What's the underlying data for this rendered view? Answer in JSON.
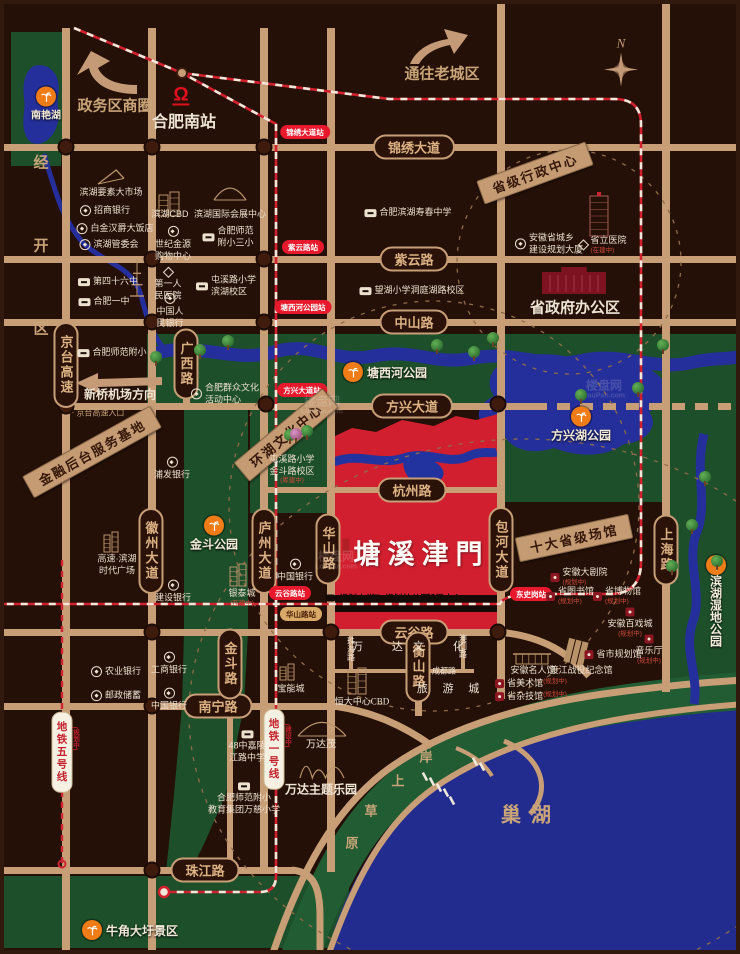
{
  "map": {
    "compass_label": "N",
    "watermark": {
      "line1": "楼盘网",
      "line2": "LouPan.com"
    },
    "colors": {
      "road": "#c89e77",
      "park_green": "#1d4f2a",
      "water_blue": "#252f9b",
      "project_red": "#d11f2f",
      "accent_tan": "#c49a74",
      "station_red": "#e8192c"
    },
    "items": [
      {
        "t": "pill",
        "x": 410,
        "y": 143,
        "s": "锦绣大道",
        "n": "road-jinxiu-avenue"
      },
      {
        "t": "pill",
        "x": 410,
        "y": 255,
        "s": "紫云路",
        "n": "road-ziyun-road"
      },
      {
        "t": "pill",
        "x": 410,
        "y": 318,
        "s": "中山路",
        "n": "road-zhongshan-road"
      },
      {
        "t": "pill",
        "x": 408,
        "y": 402,
        "s": "方兴大道",
        "n": "road-fangxing-avenue"
      },
      {
        "t": "pill",
        "x": 408,
        "y": 486,
        "s": "杭州路",
        "n": "road-hangzhou-road"
      },
      {
        "t": "pill",
        "x": 410,
        "y": 628,
        "s": "云谷路",
        "n": "road-yungu-road"
      },
      {
        "t": "pill",
        "x": 214,
        "y": 702,
        "s": "南宁路",
        "n": "road-nanning-road"
      },
      {
        "t": "pill",
        "x": 201,
        "y": 866,
        "s": "珠江路",
        "n": "road-zhujiang-road"
      },
      {
        "t": "pillv",
        "x": 62,
        "y": 361,
        "s": "京台高速",
        "n": "road-jingtai-expressway"
      },
      {
        "t": "pillv",
        "x": 182,
        "y": 360,
        "s": "广西路",
        "n": "road-guangxi-road"
      },
      {
        "t": "pillv",
        "x": 147,
        "y": 547,
        "s": "徽州大道",
        "n": "road-huizhou-avenue"
      },
      {
        "t": "pillv",
        "x": 260,
        "y": 547,
        "s": "庐州大道",
        "n": "road-luzhou-avenue"
      },
      {
        "t": "pillv",
        "x": 324,
        "y": 545,
        "s": "华山路",
        "n": "road-huashan-road"
      },
      {
        "t": "pillv",
        "x": 497,
        "y": 546,
        "s": "包河大道",
        "n": "road-baohe-avenue"
      },
      {
        "t": "pillv",
        "x": 662,
        "y": 546,
        "s": "上海路",
        "n": "road-shanghai-road"
      },
      {
        "t": "pillv",
        "x": 414,
        "y": 663,
        "s": "衡山路",
        "n": "road-hengshan-road"
      },
      {
        "t": "pillv",
        "x": 226,
        "y": 660,
        "s": "金斗路",
        "n": "road-jindou-road"
      },
      {
        "t": "st",
        "x": 301,
        "y": 128,
        "s": "锦绣大道站"
      },
      {
        "t": "st",
        "x": 299,
        "y": 243,
        "s": "紫云路站"
      },
      {
        "t": "st",
        "x": 299,
        "y": 303,
        "s": "塘西河公园站"
      },
      {
        "t": "st",
        "x": 298,
        "y": 386,
        "s": "方兴大道站"
      },
      {
        "t": "st",
        "x": 286,
        "y": 589,
        "s": "云谷路站"
      },
      {
        "t": "st2",
        "x": 297,
        "y": 610,
        "s": "华山路站"
      },
      {
        "t": "st",
        "x": 527,
        "y": 590,
        "s": "东史岗站"
      },
      {
        "t": "mtag",
        "x": 270,
        "y": 745,
        "s": "地铁一号线",
        "sub": "(建设中)",
        "n": "metro-line-1-label"
      },
      {
        "t": "mtag",
        "x": 58,
        "y": 748,
        "s": "地铁五号线",
        "sub": "(规划中)",
        "n": "metro-line-5-label"
      },
      {
        "t": "area",
        "x": 111,
        "y": 101,
        "s": "政务区商圈",
        "sz": 15,
        "c": "tan",
        "b": 1
      },
      {
        "t": "area",
        "x": 438,
        "y": 69,
        "s": "通往老城区",
        "sz": 15,
        "c": "tan",
        "b": 1
      },
      {
        "t": "area",
        "x": 180,
        "y": 116,
        "s": "合肥南站",
        "sz": 16,
        "c": "wh",
        "b": 1,
        "n": "hefei-south-station-label"
      },
      {
        "t": "rail",
        "x": 177,
        "y": 92,
        "n": "railway-station-icon"
      },
      {
        "t": "area",
        "x": 36,
        "y": 275,
        "s": "经开区",
        "sz": 15,
        "c": "tan",
        "b": 1,
        "vert": 1,
        "ls": 68
      },
      {
        "t": "area",
        "x": 571,
        "y": 303,
        "s": "省政府办公区",
        "sz": 15,
        "c": "wh",
        "b": 1
      },
      {
        "t": "area",
        "x": 527,
        "y": 809,
        "s": "巢湖",
        "sz": 20,
        "c": "tan",
        "b": 1,
        "ls": 10,
        "n": "chao-lake-label"
      },
      {
        "t": "area",
        "x": 116,
        "y": 390,
        "s": "新桥机场方向",
        "sz": 12,
        "c": "wh",
        "b": 1
      },
      {
        "t": "area",
        "x": 94,
        "y": 409,
        "s": "· 京台高速入口",
        "sz": 8,
        "c": "tan"
      },
      {
        "t": "area",
        "x": 380,
        "y": 642,
        "s": "万 达",
        "sz": 11,
        "c": "wh",
        "ls": 13
      },
      {
        "t": "area",
        "x": 441,
        "y": 642,
        "s": "文 化",
        "sz": 11,
        "c": "wh",
        "ls": 13
      },
      {
        "t": "area",
        "x": 447,
        "y": 684,
        "s": "旅 游 城",
        "sz": 11,
        "c": "wh",
        "ls": 6
      },
      {
        "t": "area",
        "x": 347,
        "y": 645,
        "s": "珠海路",
        "sz": 8,
        "c": "wh",
        "vert": 1
      },
      {
        "t": "area",
        "x": 459,
        "y": 642,
        "s": "澳门路",
        "sz": 8,
        "c": "wh",
        "vert": 1
      },
      {
        "t": "area",
        "x": 440,
        "y": 667,
        "s": "成都路",
        "sz": 8,
        "c": "wh"
      },
      {
        "t": "area",
        "x": 358,
        "y": 697,
        "s": "恒大中心CBD",
        "sz": 9,
        "c": "wh"
      },
      {
        "t": "area",
        "x": 287,
        "y": 684,
        "s": "宝能城",
        "sz": 9,
        "c": "wh"
      },
      {
        "t": "area",
        "x": 317,
        "y": 739,
        "s": "万达茂",
        "sz": 10,
        "c": "wh"
      },
      {
        "t": "area",
        "x": 317,
        "y": 785,
        "s": "万达主题乐园",
        "sz": 12,
        "c": "wh",
        "b": 1
      },
      {
        "t": "ch",
        "x": 422,
        "y": 752,
        "s": "岸"
      },
      {
        "t": "ch",
        "x": 394,
        "y": 776,
        "s": "上"
      },
      {
        "t": "ch",
        "x": 367,
        "y": 806,
        "s": "草"
      },
      {
        "t": "ch",
        "x": 348,
        "y": 838,
        "s": "原"
      },
      {
        "t": "banner",
        "x": 88,
        "y": 448,
        "s": "金融后台服务基地",
        "rot": -29
      },
      {
        "t": "banner",
        "x": 531,
        "y": 169,
        "s": "省级行政中心",
        "rot": -20
      },
      {
        "t": "banner",
        "x": 570,
        "y": 534,
        "s": "十大省级场馆",
        "rot": -12
      },
      {
        "t": "banner",
        "x": 282,
        "y": 431,
        "s": "环湖文化中心",
        "rot": -40
      },
      {
        "t": "mark",
        "x": 381,
        "y": 368,
        "s": "塘西河公园",
        "lp": "r",
        "n": "tangxihe-park-marker"
      },
      {
        "t": "mark",
        "x": 577,
        "y": 421,
        "s": "方兴湖公园",
        "lp": "b",
        "n": "fangxinghu-park-marker"
      },
      {
        "t": "mark",
        "x": 210,
        "y": 530,
        "s": "金斗公园",
        "lp": "b",
        "n": "jindou-park-marker"
      },
      {
        "t": "mark",
        "x": 126,
        "y": 926,
        "s": "牛角大圩景区",
        "lp": "r",
        "n": "niujiaodaxu-scenic-marker"
      },
      {
        "t": "mark",
        "x": 712,
        "y": 597,
        "s": "滨湖湿地公园",
        "lp": "bv",
        "n": "binhu-wetland-park-marker"
      },
      {
        "t": "mark",
        "x": 42,
        "y": 100,
        "s": "南艳湖",
        "lp": "b",
        "sz": 10,
        "n": "nanyan-lake-marker"
      },
      {
        "t": "poi",
        "x": 107,
        "y": 189,
        "ls": [
          "滨湖要素大市场"
        ]
      },
      {
        "t": "poi",
        "x": 101,
        "y": 207,
        "ic": "bank",
        "ls": [
          "招商银行"
        ]
      },
      {
        "t": "poi",
        "x": 111,
        "y": 225,
        "ic": "bank",
        "ls": [
          "白金汉爵大饭店"
        ]
      },
      {
        "t": "poi",
        "x": 105,
        "y": 241,
        "ic": "bank",
        "ls": [
          "滨湖管委会"
        ]
      },
      {
        "t": "poi",
        "x": 166,
        "y": 211,
        "ls": [
          "滨湖CBD"
        ]
      },
      {
        "t": "poi",
        "x": 169,
        "y": 240,
        "ic": "bank",
        "lay": "c",
        "ls": [
          "世纪金源",
          "购物中心"
        ]
      },
      {
        "t": "poi",
        "x": 226,
        "y": 211,
        "ls": [
          "滨湖国际会展中心"
        ]
      },
      {
        "t": "poi",
        "x": 224,
        "y": 233,
        "ic": "school",
        "ls": [
          "合肥师范",
          "附小三小"
        ]
      },
      {
        "t": "poi",
        "x": 104,
        "y": 278,
        "ic": "school",
        "ls": [
          "第四十六中"
        ]
      },
      {
        "t": "poi",
        "x": 100,
        "y": 298,
        "ic": "school",
        "ls": [
          "合肥一中"
        ]
      },
      {
        "t": "poi",
        "x": 164,
        "y": 281,
        "ic": "diamond",
        "lay": "c",
        "ls": [
          "第一人",
          "民医院"
        ]
      },
      {
        "t": "poi",
        "x": 166,
        "y": 307,
        "ic": "bank",
        "lay": "c",
        "ls": [
          "中国人",
          "民银行"
        ]
      },
      {
        "t": "poi",
        "x": 222,
        "y": 282,
        "ic": "school",
        "ls": [
          "屯溪路小学",
          "滨湖校区"
        ]
      },
      {
        "t": "poi",
        "x": 404,
        "y": 209,
        "ic": "school",
        "ls": [
          "合肥滨湖寿春中学"
        ]
      },
      {
        "t": "poi",
        "x": 408,
        "y": 287,
        "ic": "school",
        "ls": [
          "望湖小学洞庭湖路校区"
        ]
      },
      {
        "t": "poi",
        "x": 545,
        "y": 240,
        "ic": "bank",
        "ls": [
          "安徽省城乡",
          "建设规划大厦"
        ]
      },
      {
        "t": "poi",
        "x": 599,
        "y": 241,
        "ic": "diamond",
        "ls": [
          "省立医院",
          "(在建中)"
        ]
      },
      {
        "t": "poi",
        "x": 108,
        "y": 349,
        "ic": "school",
        "ls": [
          "合肥师范附小"
        ]
      },
      {
        "t": "poi",
        "x": 221,
        "y": 390,
        "ic": "bank",
        "ls": [
          "合肥群众文化",
          "活动中心"
        ]
      },
      {
        "t": "poi",
        "x": 288,
        "y": 466,
        "lay": "c",
        "ls": [
          "屯溪路小学",
          "金斗路校区",
          "(筹建中)"
        ]
      },
      {
        "t": "poi",
        "x": 291,
        "y": 567,
        "ic": "bank",
        "lay": "c",
        "ls": [
          "中国银行"
        ]
      },
      {
        "t": "poi",
        "x": 169,
        "y": 588,
        "ic": "bank",
        "lay": "c",
        "ls": [
          "建设银行"
        ]
      },
      {
        "t": "poi",
        "x": 168,
        "y": 465,
        "ic": "bank",
        "lay": "c",
        "ls": [
          "浦发银行"
        ]
      },
      {
        "t": "poi",
        "x": 112,
        "y": 668,
        "ic": "bank",
        "ls": [
          "农业银行"
        ]
      },
      {
        "t": "poi",
        "x": 112,
        "y": 692,
        "ic": "bank",
        "ls": [
          "邮政储蓄"
        ]
      },
      {
        "t": "poi",
        "x": 165,
        "y": 660,
        "ic": "bank",
        "lay": "c",
        "ls": [
          "工商银行"
        ]
      },
      {
        "t": "poi",
        "x": 165,
        "y": 696,
        "ic": "bank",
        "lay": "c",
        "ls": [
          "中国银行"
        ]
      },
      {
        "t": "poi",
        "x": 243,
        "y": 743,
        "ic": "school",
        "lay": "c",
        "ls": [
          "48中嘉陵",
          "江路中学"
        ]
      },
      {
        "t": "poi",
        "x": 240,
        "y": 795,
        "ic": "school",
        "lay": "c",
        "ls": [
          "合肥师范附小",
          "教育集团万慈小学"
        ]
      },
      {
        "t": "poi",
        "x": 113,
        "y": 561,
        "lay": "c",
        "ls": [
          "高速·滨湖",
          "时代广场"
        ]
      },
      {
        "t": "poi",
        "x": 238,
        "y": 594,
        "lay": "c",
        "ls": [
          "银泰城",
          "(在建中)"
        ]
      },
      {
        "t": "poi",
        "x": 575,
        "y": 573,
        "ic": "venue",
        "ls": [
          "安徽大剧院",
          "(规划中)"
        ]
      },
      {
        "t": "poi",
        "x": 566,
        "y": 592,
        "ic": "venue",
        "ls": [
          "省图书馆",
          "(规划中)"
        ]
      },
      {
        "t": "poi",
        "x": 613,
        "y": 592,
        "ic": "venue",
        "ls": [
          "省博物馆",
          "(规划中)"
        ]
      },
      {
        "t": "poi",
        "x": 626,
        "y": 619,
        "ic": "venue",
        "lay": "c",
        "ls": [
          "安徽百戏城",
          "(规划中)"
        ]
      },
      {
        "t": "poi",
        "x": 645,
        "y": 646,
        "ic": "venue",
        "lay": "c",
        "ls": [
          "音乐厅",
          "(规划中)"
        ]
      },
      {
        "t": "poi",
        "x": 609,
        "y": 651,
        "ic": "venue",
        "ls": [
          "省市规划馆"
        ]
      },
      {
        "t": "poi",
        "x": 529,
        "y": 667,
        "ls": [
          "安徽名人馆"
        ]
      },
      {
        "t": "poi",
        "x": 577,
        "y": 667,
        "ls": [
          "渡江战役纪念馆"
        ]
      },
      {
        "t": "poi",
        "x": 527,
        "y": 680,
        "ic": "venue",
        "lay": "i",
        "ls": [
          "省美术馆",
          "(规划中)"
        ]
      },
      {
        "t": "poi",
        "x": 527,
        "y": 693,
        "ic": "venue",
        "lay": "i",
        "ls": [
          "省杂技馆",
          "(规划中)"
        ]
      },
      {
        "t": "black",
        "x": 346,
        "y": 594,
        "s": "规划小学",
        "ic": 1
      },
      {
        "t": "black",
        "x": 396,
        "y": 594,
        "s": "规划幼儿园",
        "ic": 1
      },
      {
        "t": "black",
        "x": 440,
        "y": 594,
        "s": "邻里中心"
      },
      {
        "t": "logo",
        "x": 412,
        "y": 548,
        "s": "塘溪津門",
        "n": "project-logo-tangxijinmen"
      },
      {
        "t": "wm",
        "x": 318,
        "y": 402
      },
      {
        "t": "wm",
        "x": 600,
        "y": 386
      },
      {
        "t": "wm",
        "x": 332,
        "y": 557
      }
    ]
  }
}
